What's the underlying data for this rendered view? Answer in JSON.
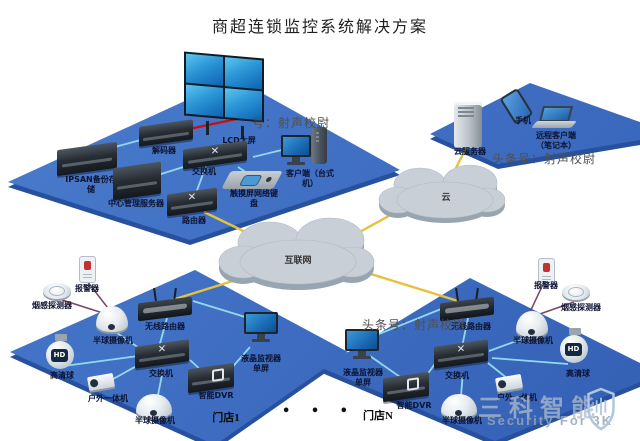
{
  "title": "商超连锁监控系统解决方案",
  "watermarks": {
    "top": "号：射声校尉",
    "right": "头条号：射声校尉",
    "middle": "头条号：射声校尉"
  },
  "clouds": {
    "internet": "互联网",
    "cloud": "云"
  },
  "center": {
    "ipsan": "IPSAN备份存储",
    "server": "中心管理服务器",
    "decoder": "解码器",
    "wall": "LCD大屏",
    "switch": "交换机",
    "keyboard": "触摸屏网络键盘",
    "client": "客户端（台式机）",
    "router": "路由器"
  },
  "remote": {
    "server": "云服务器",
    "phone": "手机",
    "laptop": "远程客户端（笔记本）"
  },
  "store1": {
    "name": "门店1",
    "alarm": "报警器",
    "smoke": "烟感探测器",
    "dome1": "半球摄像机",
    "wifi": "无线路由器",
    "ball": "高清球",
    "switch": "交换机",
    "dvr": "智能DVR",
    "outdoor": "户外一体机",
    "dome2": "半球摄像机",
    "monitor": "液晶监视器单屏"
  },
  "storeN": {
    "name": "门店N",
    "alarm": "报警器",
    "smoke": "烟感探测器",
    "dome1": "半球摄像机",
    "wifi": "无线路由器",
    "ball": "高清球",
    "switch": "交换机",
    "dvr": "智能DVR",
    "outdoor": "户外一体机",
    "dome2": "半球摄像机",
    "monitor": "液晶监视器单屏"
  },
  "ellipsis": "•  •  •",
  "badges": {
    "hd": "HD"
  },
  "icons": {
    "switch_arrows": "✕",
    "router_arrows": "✕"
  },
  "logo": {
    "cn": "三科智能",
    "en": "Security For 3K"
  },
  "colors": {
    "platform_blue": "#3f6fc4",
    "cloud_gray": "#c8cfd7",
    "lan_line": "#92d9ec",
    "wan_line": "#e6c23a",
    "video_line": "#c81010",
    "alarm_line": "#7b4663"
  }
}
